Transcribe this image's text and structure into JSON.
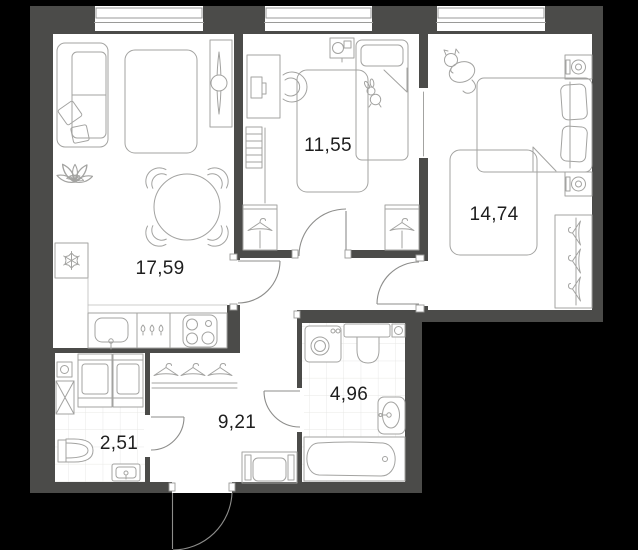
{
  "title": "apartment-floor-plan",
  "plan": {
    "background_color": "#000000",
    "wall_color": "#4b4b49",
    "floor_color": "#ffffff",
    "furniture_line_color": "#a3a3a1",
    "door_line_color": "#8d8d8b",
    "tile_line_color": "#e7e7e5",
    "label_color": "#1e1e1e"
  },
  "rooms": {
    "living_kitchen": {
      "area": "17,59"
    },
    "kids_room": {
      "area": "11,55"
    },
    "bedroom": {
      "area": "14,74"
    },
    "hallway": {
      "area": "9,21"
    },
    "bathroom": {
      "area": "4,96"
    },
    "wc": {
      "area": "2,51"
    }
  },
  "icons": {
    "snowflake-icon": "fridge position marker (crossed spokes)",
    "sofa-icon": "sofa with two pillows",
    "rug-icon": "rounded rectangle rug",
    "tv-icon": "tv console on wall",
    "plant-icon": "leafy plant",
    "dining-table-icon": "round table with 4 chairs",
    "kitchen-sink-icon": "sink with tap",
    "stove-icon": "4-burner hob",
    "desk-icon": "desk with monitor and chair",
    "shelf-icon": "ladder shelf",
    "kids-bed-icon": "single bed with pillow and bunny toy",
    "wardrobe-hanger-icon": "wardrobe with coat hanger",
    "double-bed-icon": "double bed with two pillows",
    "nightstand-icon": "nightstand with lamp",
    "cat-icon": "cat doodle",
    "washing-machine-icon": "washer with round door",
    "toilet-icon": "toilet with tank",
    "bath-sink-icon": "washbasin",
    "bathtub-icon": "bathtub with drain",
    "coat-rack-icon": "three hangers on shelf",
    "bench-icon": "entry bench",
    "entrance-door-icon": "outward swinging entry door",
    "window-icon": "window with frame lines"
  }
}
